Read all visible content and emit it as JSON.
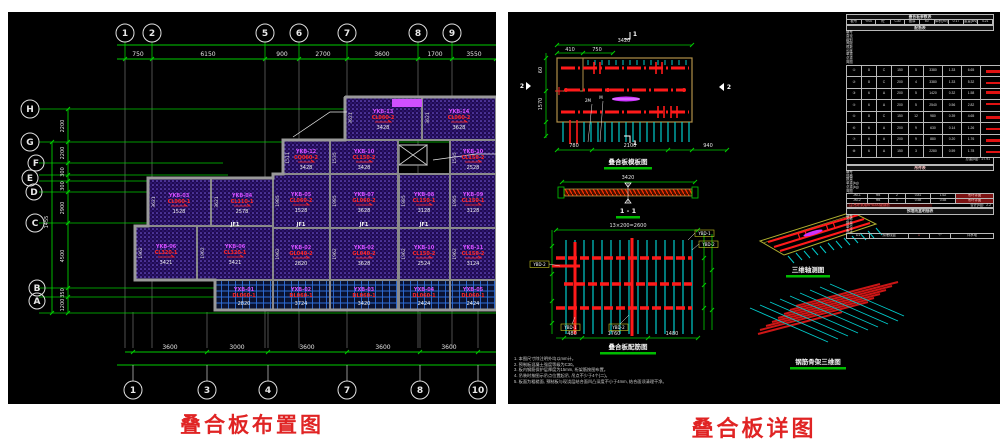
{
  "captions": {
    "left": "叠合板布置图",
    "right": "叠合板详图"
  },
  "colors": {
    "grid_green": "#00cc00",
    "dim_white": "#e3e3e3",
    "wall_gray": "#8f8f8f",
    "slab_purple": "#200a52",
    "slab_dot": "#7a5fe0",
    "label_magenta": "#d44dff",
    "label_red": "#ff2424",
    "cyan": "#00cccc",
    "rebar_red": "#ff1a1a",
    "outline_tan": "#b09048",
    "caption_red": "#e02424"
  },
  "left": {
    "top_grid": {
      "bubbles": [
        "1",
        "2",
        "5",
        "6",
        "7",
        "8",
        "9"
      ],
      "dims": [
        "750",
        "6150",
        "900",
        "2700",
        "3600",
        "1700",
        "3550"
      ]
    },
    "bottom_grid": {
      "bubbles": [
        "1",
        "3",
        "4",
        "7",
        "8",
        "10"
      ],
      "dims": [
        "3600",
        "3000",
        "3600",
        "3600",
        "3600"
      ]
    },
    "row_grid": {
      "bubbles": [
        "H",
        "G",
        "F",
        "E",
        "D",
        "C",
        "B",
        "A"
      ],
      "dims": [
        "2200",
        "2200",
        "300",
        "300",
        "2900",
        "4500",
        "350",
        "1200"
      ],
      "outer_dim": "1455"
    },
    "joints": [
      "JF1",
      "JF1",
      "JF1",
      "JF1"
    ],
    "slabs": [
      {
        "c": "YKB-13",
        "m": "CL060-2",
        "d": "3428",
        "s": "3621"
      },
      {
        "c": "YKB-14",
        "m": "CL060-2",
        "d": "3628",
        "s": "3621"
      },
      {
        "c": "YKB-12",
        "m": "CQ060-2",
        "d": "3428",
        "s": "1511"
      },
      {
        "c": "YKB-10",
        "m": "CL150-2",
        "d": "3428",
        "s": "1535"
      },
      {
        "c": "YKB-10",
        "m": "CL150-2",
        "d": "2528",
        "s": "1535"
      },
      {
        "c": "YKB-03",
        "m": "CL060-1",
        "d": "1528",
        "s": "3621"
      },
      {
        "c": "YKB-04",
        "m": "CL110-1",
        "d": "2578",
        "s": "3621"
      },
      {
        "c": "YKB-05",
        "m": "CL060-2",
        "d": "1528",
        "s": "1985"
      },
      {
        "c": "YKB-07",
        "m": "GL060-2",
        "d": "3628",
        "s": "1985"
      },
      {
        "c": "YKB-08",
        "m": "CL150-1",
        "d": "3128",
        "s": "1985"
      },
      {
        "c": "YKB-09",
        "m": "CL150-1",
        "d": "3128",
        "s": "1985"
      },
      {
        "c": "YKB-06",
        "m": "CL320-1",
        "d": "3421",
        "s": "1962"
      },
      {
        "c": "YKB-06",
        "m": "CL320-1",
        "d": "3421",
        "s": "1962"
      },
      {
        "c": "YKB-02",
        "m": "GL040-2",
        "d": "2820",
        "s": "1962"
      },
      {
        "c": "YKB-02",
        "m": "GL040-2",
        "d": "3628",
        "s": "1962"
      },
      {
        "c": "YKB-10",
        "m": "CL150-2",
        "d": "2524",
        "s": "1962"
      },
      {
        "c": "YKB-11",
        "m": "CL150-2",
        "d": "3124",
        "s": "1962"
      }
    ],
    "cyan_slabs": [
      {
        "c": "YXB-01",
        "m": "DL060-1",
        "d": "2820"
      },
      {
        "c": "YXB-02",
        "m": "DL060-1",
        "d": "3724"
      },
      {
        "c": "YXB-03",
        "m": "DL060-1",
        "d": "3420"
      },
      {
        "c": "YXB-04",
        "m": "DL060-1",
        "d": "2424"
      },
      {
        "c": "YXB-05",
        "m": "DL060-1",
        "d": "2424"
      }
    ]
  },
  "right": {
    "detail_formwork": {
      "title": "叠合板模板图",
      "dim_top": "3420",
      "dims_sub": [
        "410",
        "750"
      ],
      "dims_bottom": [
        "780",
        "2100",
        "940"
      ],
      "dim_left": "1570",
      "dim_left2": "60",
      "section_mark": "1",
      "side_mark": "2",
      "tag_a": "2M",
      "tag_b": "M"
    },
    "section": {
      "title": "1 - 1",
      "dim": "3420"
    },
    "detail_rebar": {
      "title": "叠合板配筋图",
      "dim_top": "13×200=2600",
      "dims_bottom": [
        "480",
        "1760",
        "1480"
      ],
      "tags": [
        "YBD-1",
        "YBD-2",
        "YBD-2",
        "YBD-1",
        "YBD-2"
      ]
    },
    "iso1": {
      "title": "三维轴测图"
    },
    "iso2": {
      "title": "钢筋骨架三维图"
    },
    "table": {
      "title": "叠合板参数表",
      "info": [
        "板号",
        "YKB",
        "砼",
        "C30",
        "板厚",
        "60",
        "体积(m³)",
        "0.17",
        "重量(kN)",
        "4.21"
      ],
      "rebar_title": "配筋表",
      "rebar_headers": [
        "编号",
        "直径",
        "级别",
        "间距",
        "根数",
        "长度",
        "单重",
        "总重",
        "简图"
      ],
      "rebar_rows": [
        [
          "①",
          "8",
          "C",
          "150",
          "5",
          "3380",
          "1.33",
          "6.65",
          ""
        ],
        [
          "②",
          "8",
          "C",
          "200",
          "4",
          "3380",
          "1.33",
          "5.32",
          ""
        ],
        [
          "③",
          "6",
          "A",
          "200",
          "5",
          "1420",
          "0.32",
          "1.58",
          "◂"
        ],
        [
          "④",
          "6",
          "A",
          "200",
          "5",
          "2540",
          "0.56",
          "2.82",
          "◂"
        ],
        [
          "⑤",
          "8",
          "C",
          "150",
          "12",
          "980",
          "0.39",
          "4.65",
          ""
        ],
        [
          "⑥",
          "6",
          "A",
          "200",
          "9",
          "630",
          "0.14",
          "1.26",
          ""
        ],
        [
          "⑦",
          "6",
          "A",
          "200",
          "9",
          "880",
          "0.20",
          "1.76",
          ""
        ],
        [
          "⑧",
          "6",
          "A",
          "150",
          "3",
          "2280",
          "0.59",
          "1.78",
          ""
        ]
      ],
      "rebar_total": "总重(kg)：27.91",
      "lift_title": "吊件表",
      "lift_headers": [
        "编号",
        "规格",
        "数量",
        "单重(kg)",
        "总重(kg)",
        "简图"
      ],
      "lift_rows": [
        [
          "JM-1",
          "Ф8",
          "2",
          "0.81",
          "1.62",
          "吊环详图"
        ],
        [
          "JM-2",
          "Ф8",
          "1",
          "0.58",
          "0.58",
          "吊环详图"
        ]
      ],
      "lift_note": "注:吊环采用HPB300级钢筋",
      "lift_total": "合计(kg)：2.2",
      "embed_title": "预埋线盒明细表",
      "embed_headers": [
        "编号",
        "名称",
        "数量",
        "单位",
        "备注"
      ],
      "embed_row": [
        "D1",
        "预埋线盒",
        "1",
        "个",
        "详水电"
      ]
    },
    "notes": [
      "1. 本图尺寸除注明外均以mm计。",
      "2. 预制板混凝土强度等级为C30。",
      "3. 板内钢筋保护层厚度为15mm, 桁架筋按图布置。",
      "4. 吊装时按图示吊点位置起吊, 吊点不少于4个(二)。",
      "5. 板面为粗糙面, 预制板与现浇层结合面凹凸深度不小于4mm, 结合面须清理干净。"
    ]
  }
}
